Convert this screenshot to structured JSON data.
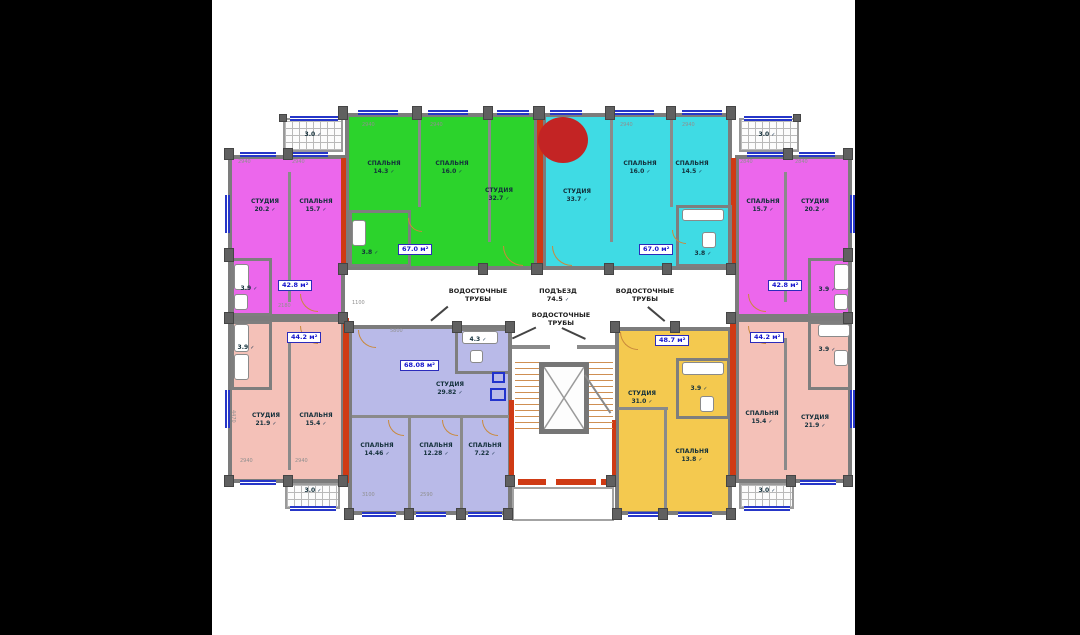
{
  "icons": {
    "check": "✓"
  },
  "colors": {
    "magenta": "#ec67ec",
    "green": "#2cd32c",
    "cyan": "#3fdbe4",
    "salmon": "#f4c1b8",
    "lavender": "#b9bae8",
    "orange": "#f4c94f",
    "red_marker": "#c32424",
    "red_wall": "#cf3a14",
    "wall_gray": "#7c7c7c",
    "window_blue": "#2636c8",
    "badge_blue": "#1414cc"
  },
  "units": [
    {
      "id": "top-left-magenta",
      "area_label": "42.8 м²",
      "rooms": [
        {
          "name": "СТУДИЯ",
          "area": "20.2"
        },
        {
          "name": "СПАЛЬНЯ",
          "area": "15.7"
        },
        {
          "name": "",
          "area": "3.9"
        }
      ]
    },
    {
      "id": "top-green",
      "area_label": "67.0 м²",
      "rooms": [
        {
          "name": "СПАЛЬНЯ",
          "area": "14.3"
        },
        {
          "name": "СПАЛЬНЯ",
          "area": "16.0"
        },
        {
          "name": "СТУДИЯ",
          "area": "32.7"
        },
        {
          "name": "",
          "area": "3.8"
        }
      ]
    },
    {
      "id": "top-cyan",
      "area_label": "67.0 м²",
      "rooms": [
        {
          "name": "СТУДИЯ",
          "area": "33.7"
        },
        {
          "name": "СПАЛЬНЯ",
          "area": "16.0"
        },
        {
          "name": "СПАЛЬНЯ",
          "area": "14.5"
        },
        {
          "name": "",
          "area": "3.8"
        }
      ]
    },
    {
      "id": "top-right-magenta",
      "area_label": "42.8 м²",
      "rooms": [
        {
          "name": "СПАЛЬНЯ",
          "area": "15.7"
        },
        {
          "name": "СТУДИЯ",
          "area": "20.2"
        },
        {
          "name": "",
          "area": "3.9"
        }
      ]
    },
    {
      "id": "bottom-left-salmon",
      "area_label": "44.2 м²",
      "rooms": [
        {
          "name": "СТУДИЯ",
          "area": "21.9"
        },
        {
          "name": "СПАЛЬНЯ",
          "area": "15.4"
        },
        {
          "name": "",
          "area": "3.9"
        }
      ]
    },
    {
      "id": "bottom-lavender",
      "area_label": "68.08 м²",
      "rooms": [
        {
          "name": "СТУДИЯ",
          "area": "29.82"
        },
        {
          "name": "СПАЛЬНЯ",
          "area": "14.46"
        },
        {
          "name": "СПАЛЬНЯ",
          "area": "12.28"
        },
        {
          "name": "СПАЛЬНЯ",
          "area": "7.22"
        },
        {
          "name": "",
          "area": "4.3"
        }
      ]
    },
    {
      "id": "bottom-orange",
      "area_label": "48.7 м²",
      "rooms": [
        {
          "name": "СТУДИЯ",
          "area": "31.0"
        },
        {
          "name": "СПАЛЬНЯ",
          "area": "13.8"
        },
        {
          "name": "",
          "area": "3.9"
        }
      ]
    },
    {
      "id": "bottom-right-salmon",
      "area_label": "44.2 м²",
      "rooms": [
        {
          "name": "СПАЛЬНЯ",
          "area": "15.4"
        },
        {
          "name": "СТУДИЯ",
          "area": "21.9"
        },
        {
          "name": "",
          "area": "3.9"
        }
      ]
    }
  ],
  "balconies": [
    {
      "area": "3.0"
    },
    {
      "area": "3.0"
    },
    {
      "area": "3.0"
    },
    {
      "area": "3.0"
    }
  ],
  "common": {
    "entrance_label": "ПОДЪЕЗД",
    "entrance_area": "74.5",
    "drain_label": "ВОДОСТОЧНЫЕ ТРУБЫ"
  },
  "dims": [
    "2940",
    "2940",
    "2940",
    "2940",
    "2940",
    "2940",
    "2840",
    "2840",
    "1100",
    "5800",
    "3100",
    "2590",
    "4470",
    "2180",
    "2940",
    "2940"
  ]
}
